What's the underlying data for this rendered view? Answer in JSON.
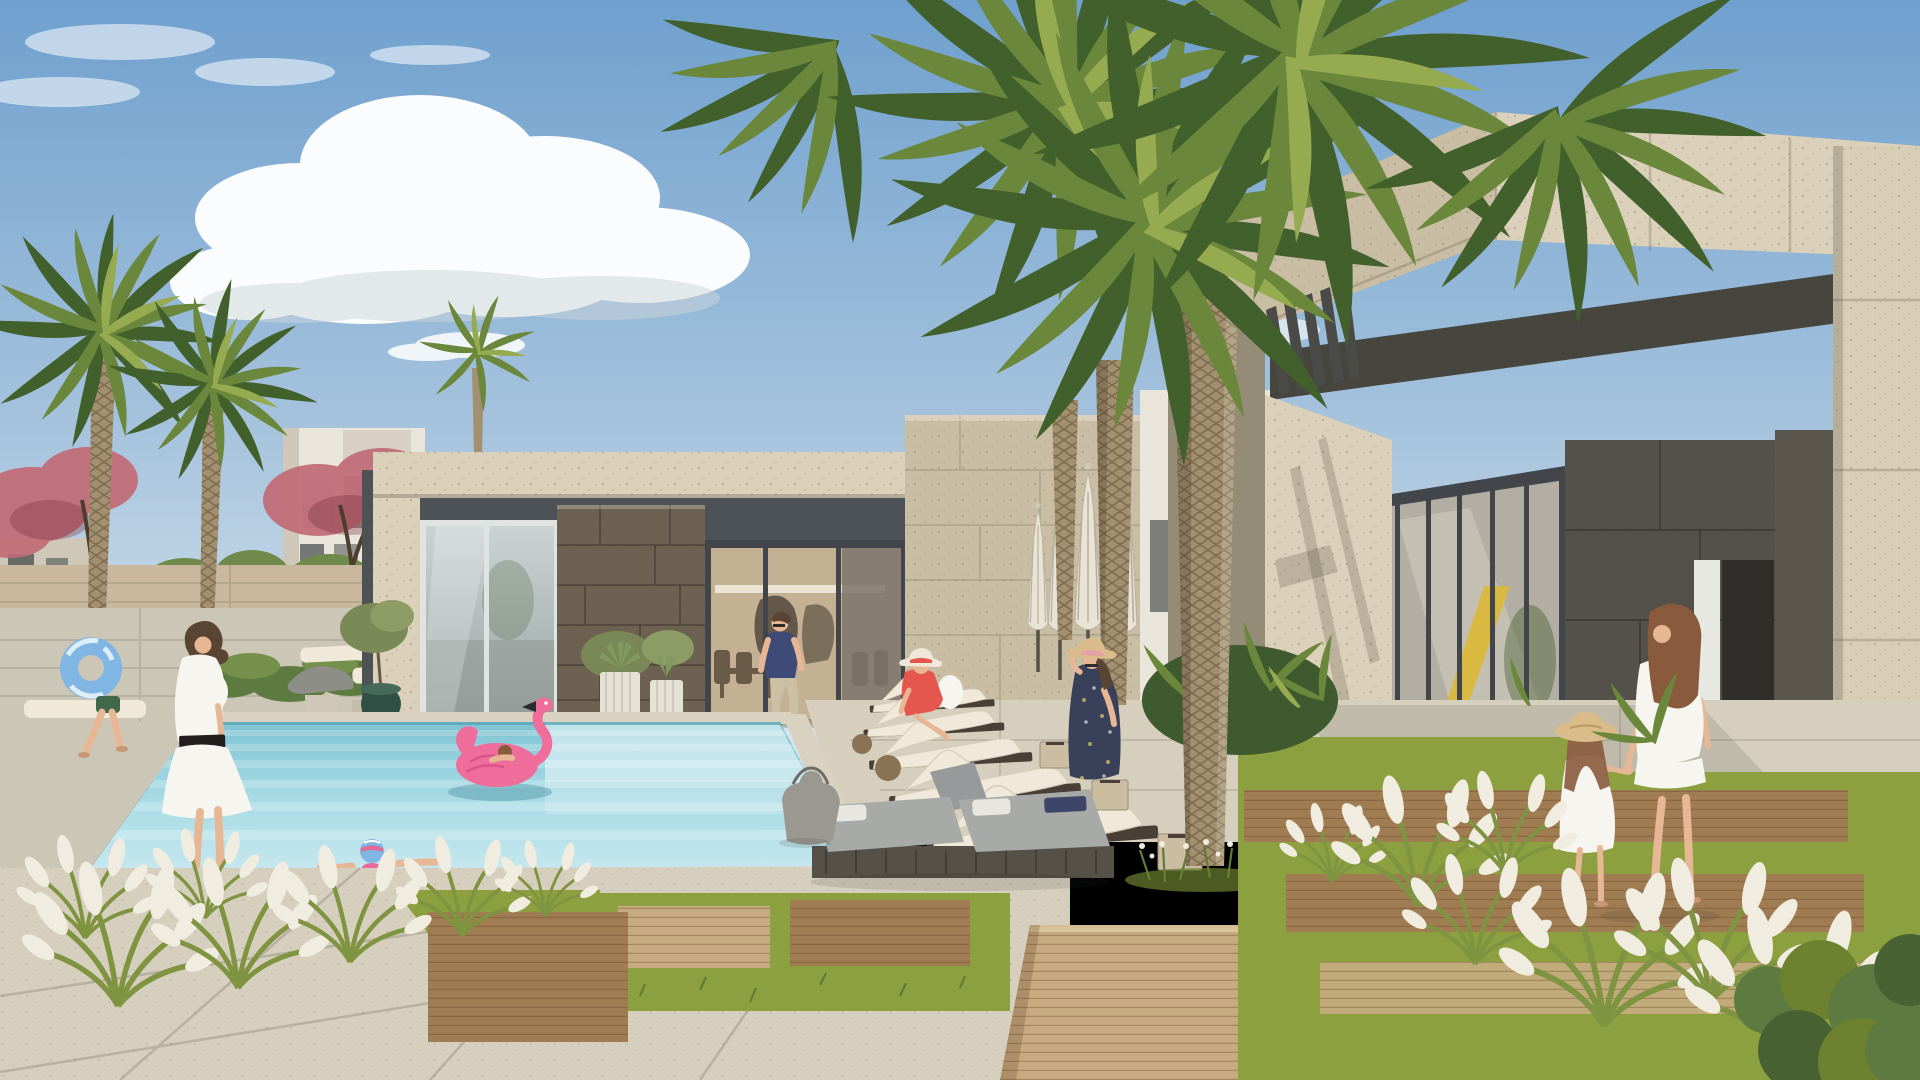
{
  "scene": {
    "type": "architectural-rendering",
    "description": "Photorealistic render of a luxury villa community amenity courtyard: turquoise swimming pool at left with a child on a pink flamingo float, a girl in a blue swim cap at the pool edge, a boy running with a blue swim ring, and a woman in white standing poolside. A flat-roofed travertine pool pavilion with glass doors sits center-left with a man in a navy t-shirt walking out. Rows of white sun loungers and furled white umbrellas line a travertine wall under tall date palms. At right, a modern travertine clubhouse with a glazed wall (yellow slide and ball inside) and a dark stone entry, where a woman in a white dress walks hand in hand with a little girl in a straw hat over wooden decking. Ornamental white-plumed grasses, lawn panels, wood paths and stone pavers fill the foreground under a blue sky with cumulus clouds.",
    "setting": "daytime, sunny, resort pool courtyard",
    "buildings": [
      {
        "name": "pool-pavilion",
        "materials": [
          "travertine parapet",
          "dark fascia",
          "brown stone wall",
          "glass sliding doors"
        ],
        "position": "center-left"
      },
      {
        "name": "clubhouse",
        "materials": [
          "travertine",
          "glass curtain wall",
          "dark stone entry",
          "pergola fins"
        ],
        "position": "right",
        "interior_feature": "yellow slide and yellow ball"
      },
      {
        "name": "background-villas",
        "materials": [
          "white render",
          "dark window frames"
        ],
        "position": "far left"
      }
    ],
    "people": [
      {
        "name": "boy-with-swim-ring",
        "clothing": "green swim shorts",
        "prop": "blue tie-dye swim ring",
        "action": "running on pool deck",
        "position": "far left"
      },
      {
        "name": "woman-poolside",
        "clothing": "white dress with black waist sash",
        "hair": "dark bob",
        "action": "standing at pool corner",
        "position": "left"
      },
      {
        "name": "girl-swimming",
        "clothing": "blue swim cap, pink goggles band, pink swimsuit",
        "action": "leaning on pool edge",
        "position": "lower left"
      },
      {
        "name": "child-on-flamingo",
        "action": "lying on pink flamingo float",
        "position": "center pool"
      },
      {
        "name": "man-at-pavilion",
        "clothing": "navy t-shirt, beige chinos, sunglasses",
        "action": "walking out of glass door",
        "position": "center"
      },
      {
        "name": "woman-in-red",
        "clothing": "coral red dress, white sun hat",
        "action": "seated on white lounger",
        "position": "center-right"
      },
      {
        "name": "woman-floral-dress",
        "clothing": "navy floral maxi dress, straw hat with pink band",
        "action": "standing, touching hat",
        "position": "right of loungers"
      },
      {
        "name": "woman-white-dress",
        "clothing": "white knee-length dress, barefoot",
        "action": "walking hand in hand with child toward entry",
        "position": "far right"
      },
      {
        "name": "girl-straw-hat",
        "clothing": "white sundress, straw hat",
        "action": "holding mother's hand",
        "position": "far right"
      }
    ],
    "vegetation": [
      "tall date palms with diamond-pattern trunks",
      "smaller palms at left",
      "pink flowering trees",
      "clipped hedges",
      "tropical planting bed",
      "fountain grasses with white plumes",
      "lawn panels",
      "agaves in white ribbed pots",
      "olive tree in dark green glazed pot"
    ],
    "props": [
      "white sun loungers on dark wood bases",
      "furled white umbrellas",
      "gray daybed cushions with white pillows",
      "gray tote bag",
      "cube side tables",
      "beige loungers",
      "sculptural gray lounger"
    ],
    "pool": {
      "water": "turquoise with step shelf and light striping",
      "edge": "light stone coping"
    }
  },
  "colors": {
    "sky_top": "#6fa0ce",
    "sky_mid": "#a6c3dd",
    "sky_horizon": "#dde9ef",
    "cloud": "#ffffff",
    "cloud_shade": "#ccd5da",
    "villa_white": "#e9e5da",
    "villa_shade": "#cfc8b9",
    "window_dark": "#4d5254",
    "bougainvillea": "#c16b76",
    "tree_green": "#6f8a4a",
    "hedge_green": "#5d7a40",
    "garden_wall": "#c9b89d",
    "trunk": "#a39070",
    "palm_dark": "#42602c",
    "palm_mid": "#6a873b",
    "palm_light": "#96ab50",
    "travertine_light": "#dbd0b9",
    "travertine": "#c9bda3",
    "travertine_shade": "#958c77",
    "fascia_dark": "#4d5257",
    "stone_brown": "#6d6152",
    "glass_top": "#ccd5d4",
    "glass_bottom": "#98a3a1",
    "interior_warm": "#c4b093",
    "entry_dark": "#54514a",
    "soffit_dark": "#46463f",
    "pier_light": "#d8cdb5",
    "pool_deep": "#7fc3d3",
    "pool_mid": "#a7dbe5",
    "pool_near": "#c8e8ef",
    "pool_step": "#d6edf2",
    "coping": "#d9d2c1",
    "waterline": "#58a3b2",
    "paver": "#ccc6b6",
    "paver_warm": "#d7cfbe",
    "wood": "#a07c52",
    "wood_light": "#c7ab80",
    "grass": "#8da03f",
    "grass_dark": "#6d8130",
    "umbrella": "#e8e3d5",
    "lounger_white": "#f0e9da",
    "daybed_gray": "#a8aaa7",
    "daybed_base": "#555048",
    "bag_gray": "#9b9892",
    "skin": "#e7b795",
    "hair_dark": "#5a4434",
    "hair_auburn": "#8a5a3c",
    "white_cloth": "#f7f5ef",
    "red_dress": "#e4564e",
    "navy": "#3d4b76",
    "floral_navy": "#394059",
    "straw": "#d9bc8a",
    "shorts_green": "#41684a",
    "float_blue": "#7fb6e3",
    "flamingo": "#ef6d9b",
    "flamingo_deep": "#d9548a",
    "pot_green": "#315045",
    "pot_white": "#e6e1d5",
    "slide_yellow": "#d9b942",
    "slat_dark": "#4a4a46"
  }
}
